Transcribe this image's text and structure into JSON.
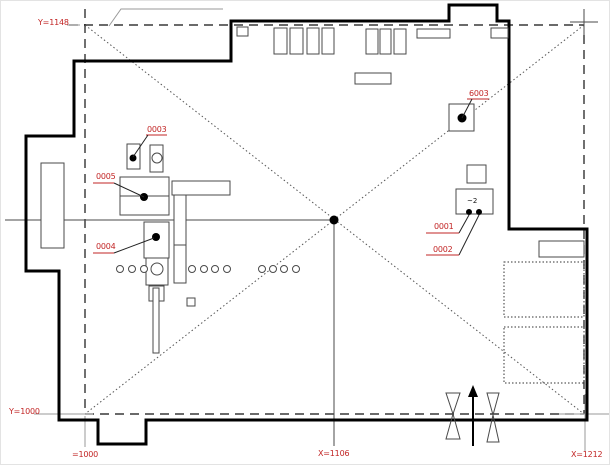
{
  "colors": {
    "label_red": "#c22525",
    "outline": "#000000",
    "thin_line": "#4a4a4a",
    "gray_line": "#9a9a9a"
  },
  "coordinate_labels": {
    "y_top": "Y=1148",
    "y_bottom": "Y=1000",
    "x_origin": "=1000",
    "x_center": "X=1106",
    "x_right": "X=1212"
  },
  "component_labels": {
    "c0003": "0003",
    "c0005": "0005",
    "c0004": "0004",
    "c6003": "6003",
    "c0001": "0001",
    "c0002": "0002"
  },
  "annotations": {
    "module_text": "~2"
  }
}
